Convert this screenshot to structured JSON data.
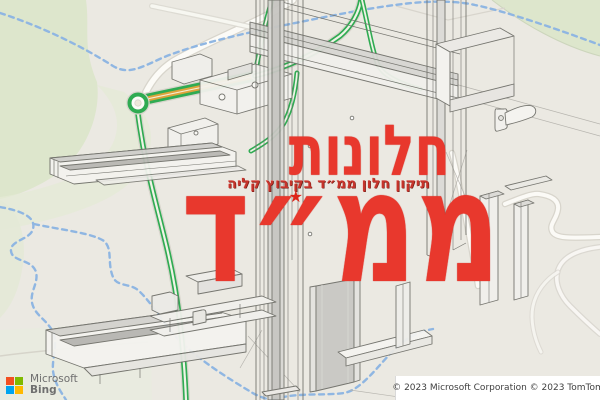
{
  "watermark": {
    "title": "חלונות",
    "subtitle": "תיקון חלון ממ״ד בקיבוץ קליה",
    "big_word": "ממ״ד",
    "star_icon": "★",
    "color": "#e8382d"
  },
  "logo": {
    "company": "Microsoft",
    "product": "Bing",
    "tile_colors": {
      "red": "#f25022",
      "green": "#7fba00",
      "blue": "#00a4ef",
      "yellow": "#ffb900"
    }
  },
  "attribution": "© 2023 Microsoft Corporation © 2023 TomTom",
  "map": {
    "background": "#ebe9e2",
    "park_color": "#dde6cc",
    "park_color_light": "#e6ecd8",
    "road_fill": "#fcfbf7",
    "road_casing": "#d8d5cc",
    "trail_color": "#8fb6e2",
    "route_green": "#2fab52",
    "route_orange": "#dda43c"
  },
  "diagram": {
    "label": "isometric window profile drawing",
    "line_color": "#70706a"
  }
}
